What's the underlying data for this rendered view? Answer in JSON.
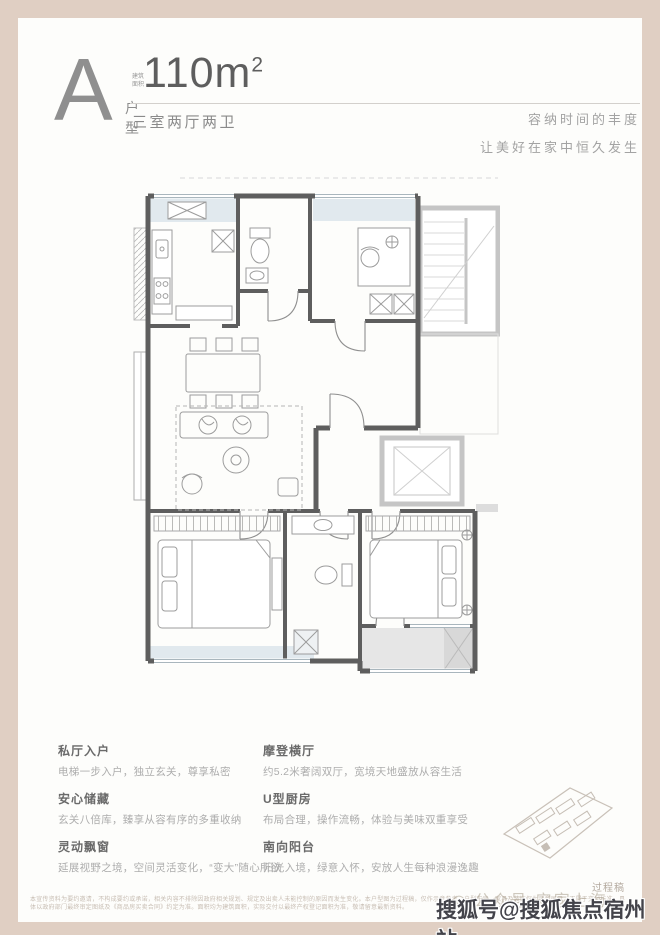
{
  "colors": {
    "frame": "#e0cfc3",
    "card": "#fdfdfb",
    "wall": "#5e5e5e",
    "common_wall": "#c5c5c5",
    "window_fill": "#e1e9ee",
    "balcony_fill": "#e6e6e6"
  },
  "header": {
    "type_letter": "A",
    "type_label": "户型",
    "area_prefix": "建筑面积",
    "area_value": "110m",
    "area_sup": "2",
    "spec": "三室两厅两卫",
    "slogan_line1": "容纳时间的丰度",
    "slogan_line2": "让美好在家中恒久发生"
  },
  "features": [
    {
      "title": "私厅入户",
      "desc": "电梯一步入户，独立玄关，尊享私密"
    },
    {
      "title": "安心储藏",
      "desc": "玄关八倍库，臻享从容有序的多重收纳"
    },
    {
      "title": "灵动飘窗",
      "desc": "延展视野之境，空间灵活变化，“变大”随心所欲"
    },
    {
      "title": "摩登横厅",
      "desc": "约5.2米奢阔双厅，宽境天地盛放从容生活"
    },
    {
      "title": "U型厨房",
      "desc": "布局合理，操作流畅，体验与美味双重享受"
    },
    {
      "title": "南向阳台",
      "desc": "阳光入境，绿意入怀，安放人生每种浪漫逸趣"
    }
  ],
  "siteplan": {
    "caption": "过程稿"
  },
  "disclaimer": "本宣传资料为要约邀请，不构成要约或承诺，相关内容不排除因政府相关规划、规定及出卖人未能控制的原因而发生变化。本户型图为过程稿，仅作示意参考，户型布局、家具及装饰仅为示意展示，不属于交付标准，具体以政府部门最终审定图纸及《商品房买卖合同》约定为准。面积均为建筑面积，实际交付以最终产权登记面积为准，敬请留意最新资料。",
  "watermark": {
    "back": "◎ 公众号·安家上海",
    "front": "搜狐号@搜狐焦点宿州站"
  }
}
